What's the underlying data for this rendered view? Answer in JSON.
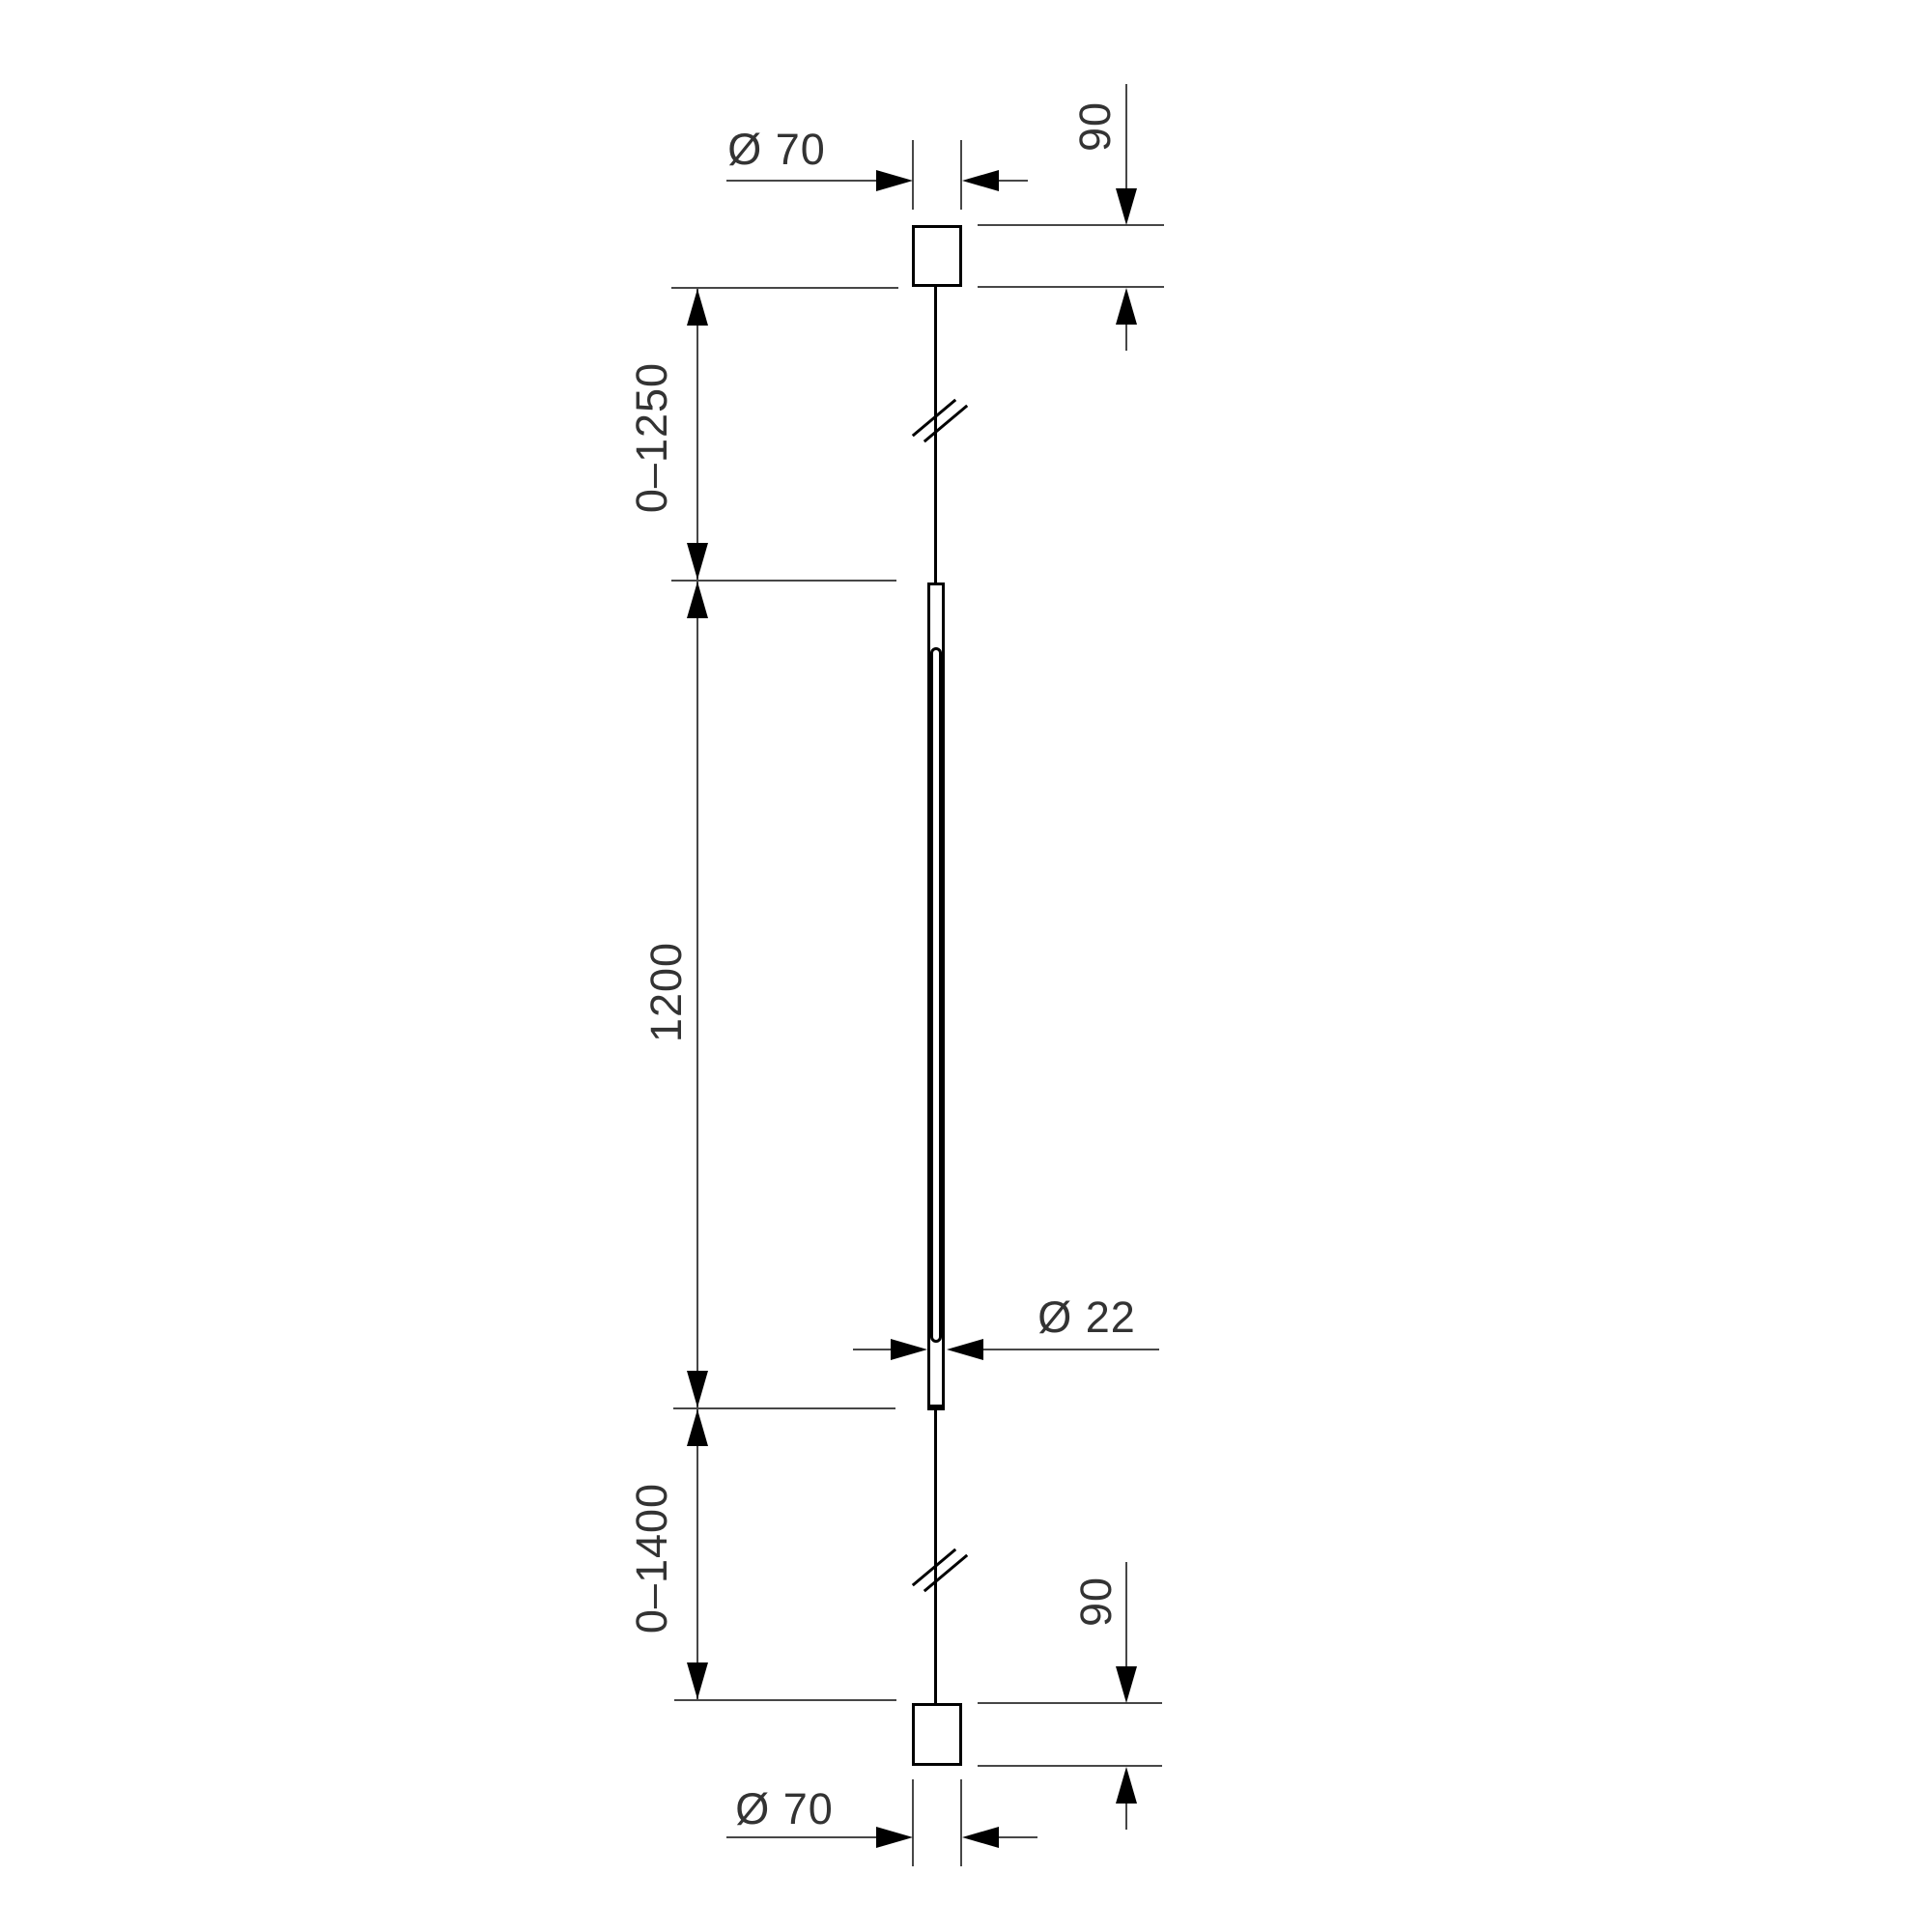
{
  "drawing": {
    "colors": {
      "object_line": "#000000",
      "dimension_line": "#474747",
      "text": "#333333",
      "background": "#ffffff"
    },
    "labels": {
      "top_canopy_diameter": "Ø 70",
      "top_canopy_height": "90",
      "top_suspension_range": "0–1250",
      "luminaire_length": "1200",
      "bottom_suspension_range": "0–1400",
      "tube_diameter": "Ø 22",
      "bottom_canopy_height": "90",
      "bottom_canopy_diameter": "Ø 70"
    }
  }
}
